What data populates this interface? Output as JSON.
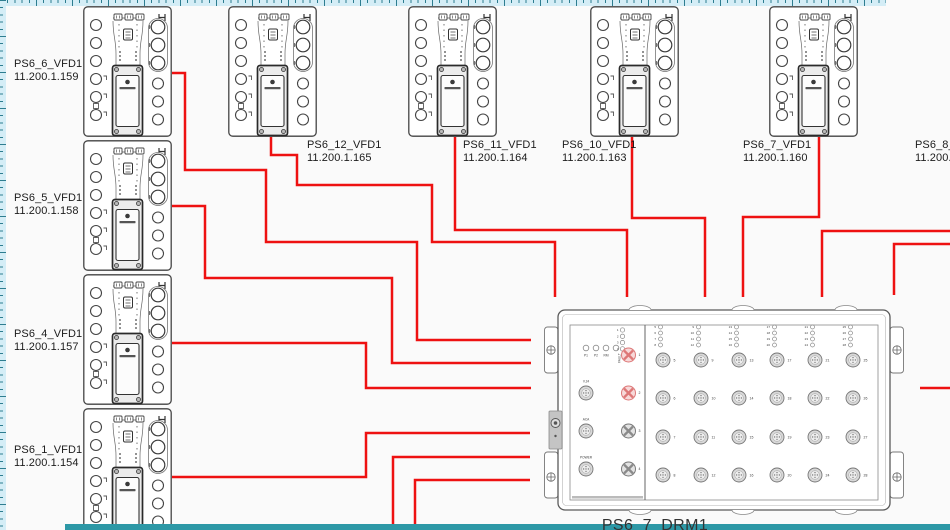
{
  "canvas": {
    "bg": "#fafafa",
    "wire_color": "#ee1111",
    "wire_width": 2.5
  },
  "rulers": {
    "tape_bg": "#d4edf6",
    "tick_color": "#2d7d90",
    "bottom_bar_color": "#2d98a6"
  },
  "vfd_devices": [
    {
      "id": "ps6_6",
      "name": "PS6_6_VFD1",
      "ip": "11.200.1.159",
      "x": 83,
      "y": 6,
      "label": {
        "x": 14,
        "y": 58
      }
    },
    {
      "id": "ps6_5",
      "name": "PS6_5_VFD1",
      "ip": "11.200.1.158",
      "x": 83,
      "y": 140,
      "label": {
        "x": 14,
        "y": 192
      }
    },
    {
      "id": "ps6_4",
      "name": "PS6_4_VFD1",
      "ip": "11.200.1.157",
      "x": 83,
      "y": 274,
      "label": {
        "x": 14,
        "y": 328
      }
    },
    {
      "id": "ps6_1",
      "name": "PS6_1_VFD1",
      "ip": "11.200.1.154",
      "x": 83,
      "y": 408,
      "label": {
        "x": 14,
        "y": 444
      }
    },
    {
      "id": "ps6_12",
      "name": "PS6_12_VFD1",
      "ip": "11.200.1.165",
      "x": 228,
      "y": 6,
      "label": {
        "x": 307,
        "y": 139
      }
    },
    {
      "id": "ps6_11",
      "name": "PS6_11_VFD1",
      "ip": "11.200.1.164",
      "x": 408,
      "y": 6,
      "label": {
        "x": 463,
        "y": 139
      }
    },
    {
      "id": "ps6_10",
      "name": "PS6_10_VFD1",
      "ip": "11.200.1.163",
      "x": 590,
      "y": 6,
      "label": {
        "x": 562,
        "y": 139
      }
    },
    {
      "id": "ps6_7",
      "name": "PS6_7_VFD1",
      "ip": "11.200.1.160",
      "x": 769,
      "y": 6,
      "label": {
        "x": 743,
        "y": 139
      }
    }
  ],
  "partial_label": {
    "name": "PS6_8_V",
    "ip": "11.200.1",
    "x": 915,
    "y": 139
  },
  "switch": {
    "label": "PS6_7_DRM1",
    "x": 543,
    "y": 303,
    "status_leds": [
      "P1",
      "P2",
      "RM",
      "FAULT"
    ],
    "aux_ports": [
      "V.24",
      "ACA",
      "POWER"
    ],
    "led_numbers_left": [
      1,
      2,
      3,
      4
    ],
    "access_ports": [
      {
        "n": 1,
        "highlight": true
      },
      {
        "n": 2,
        "highlight": true
      },
      {
        "n": 3,
        "highlight": false
      },
      {
        "n": 4,
        "highlight": false
      }
    ],
    "port_columns": [
      [
        5,
        6,
        7,
        8
      ],
      [
        9,
        10,
        11,
        12
      ],
      [
        13,
        14,
        15,
        16
      ],
      [
        17,
        18,
        19,
        20
      ],
      [
        21,
        22,
        23,
        24
      ],
      [
        25,
        26,
        27,
        28
      ]
    ],
    "highlight_color": "#dd7777"
  },
  "wires": [
    {
      "id": "ps6_6",
      "points": [
        [
          172,
          73
        ],
        [
          185,
          73
        ],
        [
          185,
          170
        ],
        [
          266,
          170
        ],
        [
          266,
          242
        ],
        [
          417,
          242
        ],
        [
          417,
          340
        ],
        [
          531,
          340
        ]
      ]
    },
    {
      "id": "ps6_5",
      "points": [
        [
          172,
          206
        ],
        [
          205,
          206
        ],
        [
          205,
          278
        ],
        [
          392,
          278
        ],
        [
          392,
          363
        ],
        [
          531,
          363
        ]
      ]
    },
    {
      "id": "ps6_4",
      "points": [
        [
          172,
          343
        ],
        [
          366,
          343
        ],
        [
          366,
          388
        ],
        [
          531,
          388
        ]
      ]
    },
    {
      "id": "ps6_1",
      "points": [
        [
          172,
          477
        ],
        [
          366,
          477
        ],
        [
          366,
          433
        ],
        [
          530,
          433
        ]
      ]
    },
    {
      "id": "bottom_a",
      "points": [
        [
          393,
          531
        ],
        [
          393,
          457
        ],
        [
          530,
          457
        ]
      ]
    },
    {
      "id": "bottom_b",
      "points": [
        [
          415,
          531
        ],
        [
          415,
          480
        ],
        [
          530,
          480
        ]
      ]
    },
    {
      "id": "ps6_12",
      "points": [
        [
          271,
          137
        ],
        [
          271,
          155
        ],
        [
          297,
          155
        ],
        [
          297,
          185
        ],
        [
          432,
          185
        ],
        [
          432,
          242
        ],
        [
          555,
          242
        ],
        [
          555,
          297
        ]
      ]
    },
    {
      "id": "ps6_11",
      "points": [
        [
          455,
          137
        ],
        [
          455,
          230
        ],
        [
          627,
          230
        ],
        [
          627,
          297
        ]
      ]
    },
    {
      "id": "ps6_10",
      "points": [
        [
          632,
          137
        ],
        [
          632,
          218
        ],
        [
          705,
          218
        ],
        [
          705,
          297
        ]
      ]
    },
    {
      "id": "ps6_7",
      "points": [
        [
          819,
          137
        ],
        [
          819,
          217
        ],
        [
          743,
          217
        ],
        [
          743,
          297
        ]
      ]
    },
    {
      "id": "ps6_8",
      "points": [
        [
          951,
          231
        ],
        [
          822,
          231
        ],
        [
          822,
          297
        ]
      ]
    },
    {
      "id": "right_a",
      "points": [
        [
          951,
          244
        ],
        [
          894,
          244
        ],
        [
          894,
          295
        ]
      ]
    },
    {
      "id": "right_stub",
      "points": [
        [
          951,
          388
        ],
        [
          920,
          388
        ]
      ]
    }
  ]
}
